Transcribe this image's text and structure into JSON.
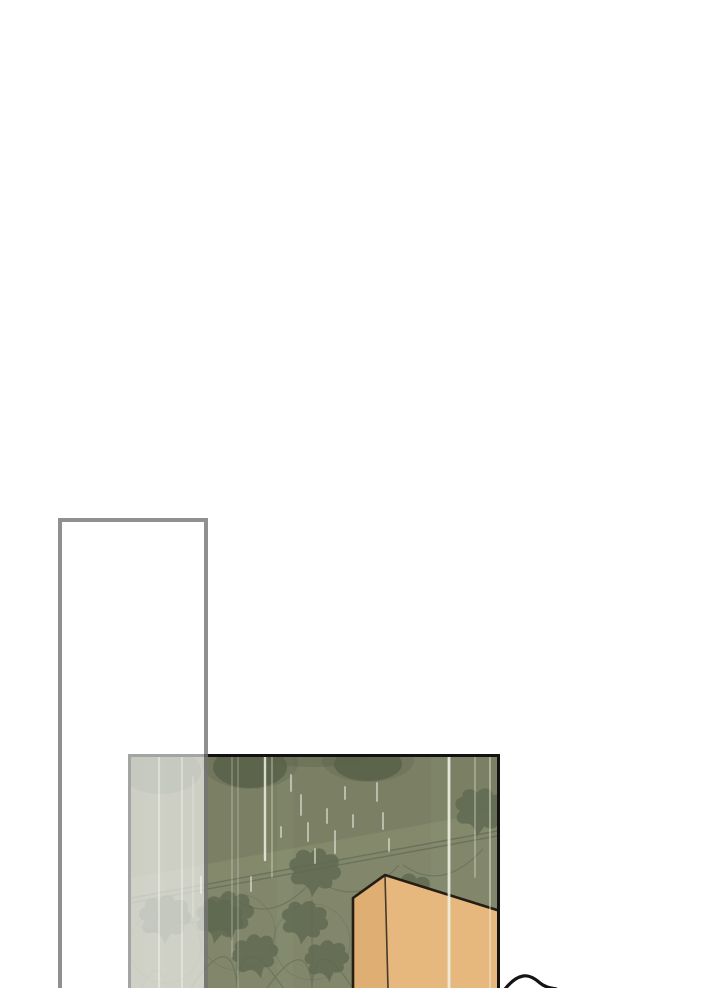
{
  "scene": {
    "type": "webtoon-comic-page",
    "description": "Vertical-scroll comic strip segment: blank white gutter, an empty translucent bordered panel overlapping a lower panel that shows a rain-streaked olive ivy-wallpapered wall with a tan wardrobe box; a black curved outline enters from the bottom edge.",
    "panel": {
      "content": "rainy interior wall with art-nouveau ivy wallpaper border and tan box",
      "rain_streaks": "vertical light streaks of varying brightness",
      "wallpaper_motif": "hanging ivy leaves on diagonal double rail with swag arcs"
    },
    "overlay": {
      "content": "empty translucent white rectangle with gray border, no text"
    },
    "figure": {
      "content": "black arc of an unseen object cut off by bottom edge"
    }
  },
  "colors": {
    "page_bg": "#ffffff",
    "panel_border": "#121212",
    "wall": "#7b8065",
    "wall_light": "#8a8e73",
    "wall_pale": "#9da281",
    "shadow": "#59614a",
    "vine": "#68725a",
    "leaf": "#5f6950",
    "rain": "#eef0e2",
    "box_front": "#e7b87d",
    "box_side": "#dfae72",
    "box_outline": "#241d14",
    "crease": "#473a2a",
    "overlay_fill": "rgba(255,255,255,0.62)",
    "overlay_border": "rgba(20,20,20,0.47)",
    "figure_line": "#141414"
  }
}
